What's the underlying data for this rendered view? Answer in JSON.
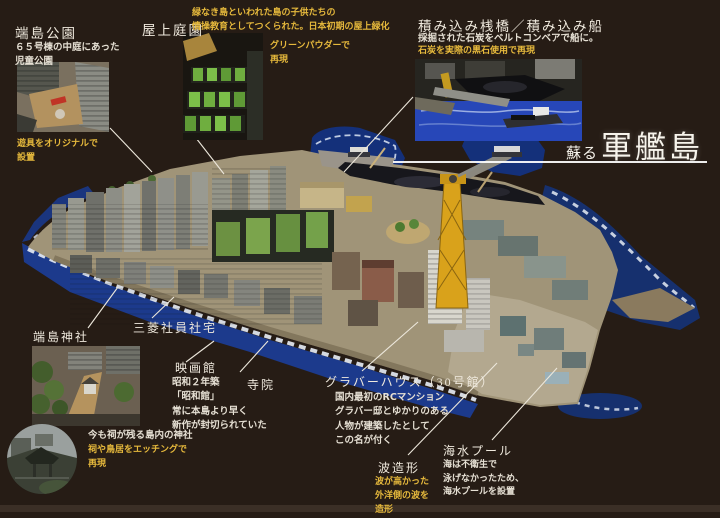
{
  "title": {
    "prefix": "蘇る",
    "main": "軍艦島"
  },
  "colors": {
    "background": "#261c15",
    "accent_yellow": "#e6b93c",
    "text_white": "#efe9dd",
    "sea_blue": "#1d3a8c",
    "island_concrete": "#a09478",
    "crane_yellow": "#d9a21b"
  },
  "callouts": {
    "hashima_park": {
      "title": "端島公園",
      "desc": "６５号棟の中庭にあった\n児童公園",
      "caption": "遊具をオリジナルで\n設置"
    },
    "rooftop_garden": {
      "title": "屋上庭園",
      "desc": "緑なき島といわれた島の子供たちの\n情操教育としてつくられた。日本初期の屋上緑化",
      "caption": "グリーンパウダーで\n再現"
    },
    "loading_pier": {
      "title": "積み込み桟橋／積み込み船",
      "desc": "採掘された石炭をベルトコンベアで船に。",
      "caption": "石炭を実際の黒石使用で再現"
    },
    "hashima_shrine": {
      "title": "端島神社",
      "note_white": "今も祠が残る島内の神社",
      "note_yellow": "祠や鳥居をエッチングで\n再現"
    },
    "mitsubishi_housing": {
      "title": "三菱社員社宅"
    },
    "cinema": {
      "title": "映画館",
      "desc": "昭和２年築\n「昭和館」\n常に本島より早く\n新作が封切られていた"
    },
    "temple": {
      "title": "寺院"
    },
    "glover_house": {
      "title": "グラバーハウス（30号館）",
      "desc": "国内最初のRCマンション\nグラバー邸とゆかりのある\n人物が建築したとして\nこの名が付く"
    },
    "wave_forming": {
      "title": "波造形",
      "desc": "波が高かった\n外洋側の波を\n造形"
    },
    "seawater_pool": {
      "title": "海水プール",
      "desc": "海は不衛生で\n泳げなかったため、\n海水プールを設置"
    }
  }
}
